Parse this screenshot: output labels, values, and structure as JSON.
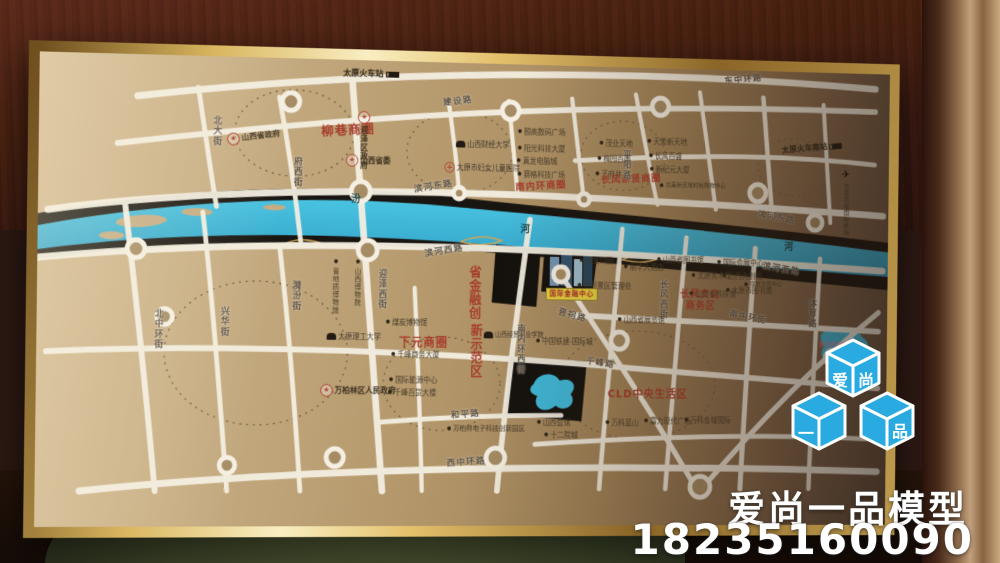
{
  "watermark": {
    "cube_chars": [
      "爱",
      "尚",
      "一",
      "品"
    ],
    "company": "爱尚一品模型",
    "phone": "18235160090",
    "logo_blue": "#29abe2"
  },
  "icons": {
    "star": "★",
    "dot": "●",
    "plane": "✈",
    "cross": "+"
  },
  "map": {
    "colors": {
      "river_blue": "#3fb9da",
      "road_white": "#f4efe2",
      "district_red": "#a63c2b",
      "board_bronze_light": "#d2b88f",
      "board_bronze_dark": "#63503f",
      "frame_gold": "#d9b65f",
      "project_tag_yellow": "#e6d23f"
    },
    "labels": [
      {
        "t": "太原火车站",
        "x": 312,
        "y": 10,
        "k": "station"
      },
      {
        "t": "东中环路",
        "x": 722,
        "y": 6,
        "k": "road",
        "r": -7
      },
      {
        "t": "建设路",
        "x": 418,
        "y": 36,
        "k": "road",
        "r": -7
      },
      {
        "t": "北大街",
        "x": 176,
        "y": 60,
        "k": "roadv"
      },
      {
        "t": "府西街",
        "x": 260,
        "y": 100,
        "k": "roadv"
      },
      {
        "t": "柳巷商圈",
        "x": 290,
        "y": 66,
        "k": "biz",
        "r": -4,
        "s": 13
      },
      {
        "t": "迎泽区政府",
        "x": 328,
        "y": 52,
        "k": "govv"
      },
      {
        "t": "山西省政府",
        "x": 192,
        "y": 74,
        "k": "gov",
        "r": -8
      },
      {
        "t": "山西省委",
        "x": 316,
        "y": 96,
        "k": "gov"
      },
      {
        "t": "山西财经大学",
        "x": 432,
        "y": 80,
        "k": "uni"
      },
      {
        "t": "太原市妇女儿童医院",
        "x": 420,
        "y": 102,
        "k": "hospital"
      },
      {
        "t": "颐高数码广场",
        "x": 498,
        "y": 66
      },
      {
        "t": "阳光科技大厦",
        "x": 498,
        "y": 83
      },
      {
        "t": "真龙电脑城",
        "x": 497,
        "y": 96
      },
      {
        "t": "赛格科技广场",
        "x": 498,
        "y": 110
      },
      {
        "t": "南内环商圈",
        "x": 496,
        "y": 121,
        "k": "biz",
        "r": -4
      },
      {
        "t": "茂业天地",
        "x": 586,
        "y": 76
      },
      {
        "t": "梅园百盛",
        "x": 584,
        "y": 92
      },
      {
        "t": "王府井",
        "x": 582,
        "y": 108
      },
      {
        "t": "天美新天地",
        "x": 638,
        "y": 73
      },
      {
        "t": "长风百盛",
        "x": 640,
        "y": 88
      },
      {
        "t": "新纪元大厦",
        "x": 641,
        "y": 102
      },
      {
        "t": "北美新天地时尚购物中心",
        "x": 652,
        "y": 119,
        "s": 6
      },
      {
        "t": "长风亲贤商圈",
        "x": 588,
        "y": 112,
        "k": "biz",
        "r": -3
      },
      {
        "t": "平阳路",
        "x": 610,
        "y": 86,
        "k": "roadv"
      },
      {
        "t": "太原火车南站",
        "x": 786,
        "y": 76,
        "k": "station",
        "r": -6
      },
      {
        "t": "太原武宿国际机场",
        "x": 852,
        "y": 100,
        "k": "airportv",
        "s": 6
      },
      {
        "t": "滨河东路",
        "x": 388,
        "y": 124,
        "k": "road",
        "r": -10
      },
      {
        "t": "滨河东路",
        "x": 760,
        "y": 150,
        "k": "road",
        "r": 9
      },
      {
        "t": "汾",
        "x": 322,
        "y": 138,
        "k": "river"
      },
      {
        "t": "河",
        "x": 502,
        "y": 166,
        "k": "river"
      },
      {
        "t": "河",
        "x": 790,
        "y": 180,
        "k": "river"
      },
      {
        "t": "滨河西路",
        "x": 400,
        "y": 190,
        "k": "road",
        "r": -10
      },
      {
        "t": "滨河西路",
        "x": 766,
        "y": 204,
        "k": "road",
        "r": 9
      },
      {
        "t": "迎泽西街",
        "x": 350,
        "y": 213,
        "k": "roadv"
      },
      {
        "t": "省地质博物馆",
        "x": 303,
        "y": 203,
        "k": "poiv",
        "s": 7
      },
      {
        "t": "山西博物院",
        "x": 326,
        "y": 203,
        "k": "poiv",
        "s": 7
      },
      {
        "t": "北中环街",
        "x": 118,
        "y": 256,
        "k": "roadv"
      },
      {
        "t": "兴华街",
        "x": 186,
        "y": 253,
        "k": "roadv"
      },
      {
        "t": "漪汾街",
        "x": 260,
        "y": 226,
        "k": "roadv"
      },
      {
        "t": "天龙公园",
        "x": 566,
        "y": 198
      },
      {
        "t": "丽华大酒店",
        "x": 614,
        "y": 204
      },
      {
        "t": "汾河景区管理处",
        "x": 564,
        "y": 224
      },
      {
        "t": "长风西街",
        "x": 652,
        "y": 220,
        "k": "roadv"
      },
      {
        "t": "长风文化",
        "x": 676,
        "y": 231,
        "k": "biz"
      },
      {
        "t": "商务区",
        "x": 682,
        "y": 243,
        "k": "biz"
      },
      {
        "t": "山西省图书馆",
        "x": 650,
        "y": 196
      },
      {
        "t": "国际会展中心",
        "x": 716,
        "y": 198
      },
      {
        "t": "太原美术馆",
        "x": 688,
        "y": 212
      },
      {
        "t": "山西大剧院",
        "x": 722,
        "y": 212
      },
      {
        "t": "煤炭交易中心",
        "x": 746,
        "y": 221,
        "s": 6
      },
      {
        "t": "山西省科技馆",
        "x": 686,
        "y": 231
      },
      {
        "t": "太原市图书馆",
        "x": 726,
        "y": 227
      },
      {
        "t": "南中环街",
        "x": 730,
        "y": 255,
        "k": "road",
        "r": 10
      },
      {
        "t": "体育路",
        "x": 816,
        "y": 238,
        "k": "roadv"
      },
      {
        "t": "太原理工大学",
        "x": 298,
        "y": 279,
        "k": "uni"
      },
      {
        "t": "煤炭博物馆",
        "x": 360,
        "y": 264
      },
      {
        "t": "下元商圈",
        "x": 374,
        "y": 282,
        "k": "biz",
        "s": 12
      },
      {
        "t": "千峰商务大厦",
        "x": 366,
        "y": 297
      },
      {
        "t": "省金融创",
        "x": 446,
        "y": 208,
        "k": "bizv",
        "s": 13
      },
      {
        "t": "新示范区",
        "x": 448,
        "y": 268,
        "k": "bizv",
        "s": 13
      },
      {
        "t": "山西经贸职业学院",
        "x": 464,
        "y": 276,
        "k": "uni",
        "s": 6.5
      },
      {
        "t": "南内环西街",
        "x": 498,
        "y": 268,
        "k": "roadv"
      },
      {
        "t": "中国铁建·国际城",
        "x": 520,
        "y": 282
      },
      {
        "t": "晋祠路",
        "x": 543,
        "y": 255,
        "k": "road",
        "r": 14
      },
      {
        "t": "山西省展览馆",
        "x": 608,
        "y": 259
      },
      {
        "t": "万柏林区人民政府",
        "x": 292,
        "y": 331,
        "k": "gov"
      },
      {
        "t": "国际能源中心",
        "x": 364,
        "y": 323
      },
      {
        "t": "千峰百货大楼",
        "x": 363,
        "y": 336
      },
      {
        "t": "千峰路",
        "x": 574,
        "y": 304,
        "k": "road",
        "r": 7
      },
      {
        "t": "CLD中央生活区",
        "x": 598,
        "y": 334,
        "k": "biz",
        "s": 11
      },
      {
        "t": "和平路",
        "x": 430,
        "y": 358,
        "k": "road",
        "r": -5
      },
      {
        "t": "万柏林电子科技创新园区",
        "x": 426,
        "y": 373,
        "s": 7
      },
      {
        "t": "山西会馆",
        "x": 522,
        "y": 366
      },
      {
        "t": "十二院城",
        "x": 530,
        "y": 379
      },
      {
        "t": "万科蓝山",
        "x": 596,
        "y": 366
      },
      {
        "t": "富力现代广场",
        "x": 638,
        "y": 364
      },
      {
        "t": "万科金域国际",
        "x": 682,
        "y": 363
      },
      {
        "t": "西中环路",
        "x": 426,
        "y": 407,
        "k": "road",
        "r": -4
      },
      {
        "t": "晋阳湖景区",
        "x": 830,
        "y": 284,
        "k": "pink"
      },
      {
        "t": "国际金融中心",
        "x": 530,
        "y": 230,
        "k": "tag"
      }
    ]
  }
}
